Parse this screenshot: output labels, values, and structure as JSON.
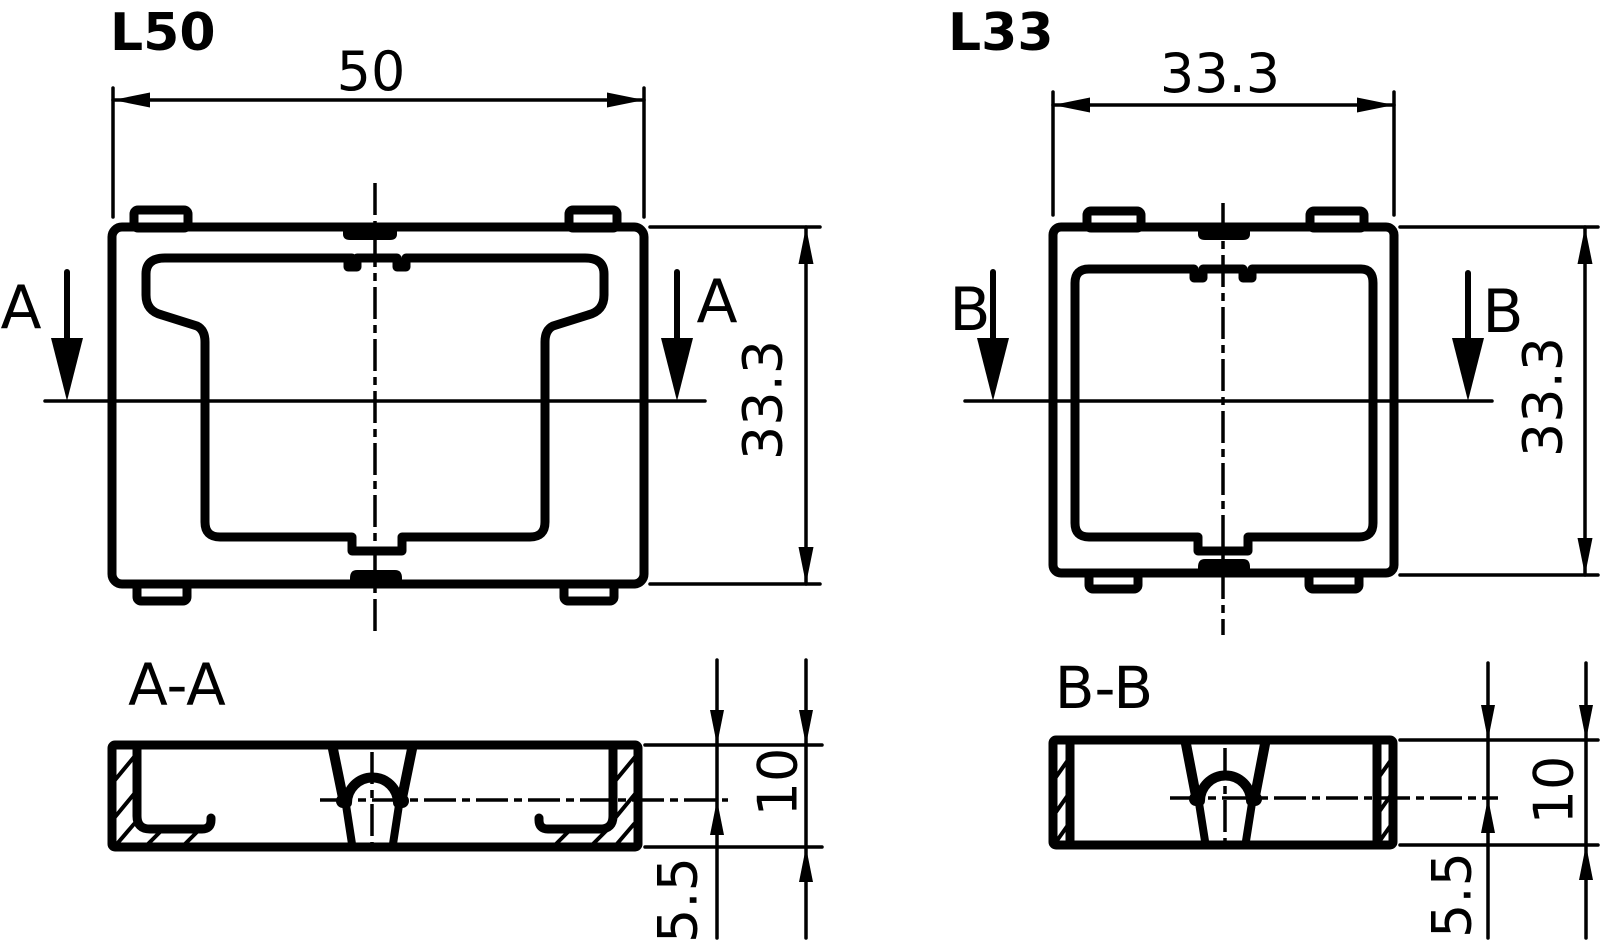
{
  "page": {
    "background": "#ffffff",
    "line_color": "#000000"
  },
  "parts": {
    "left": {
      "label": "L50",
      "top_view": {
        "width_dim": "50",
        "height_dim": "33.3",
        "section_letter": "A"
      },
      "section": {
        "title": "A-A",
        "height_dim": "10",
        "base_dim": "5.5"
      }
    },
    "right": {
      "label": "L33",
      "top_view": {
        "width_dim": "33.3",
        "height_dim": "33.3",
        "section_letter": "B"
      },
      "section": {
        "title": "B-B",
        "height_dim": "10",
        "base_dim": "5.5"
      }
    }
  }
}
